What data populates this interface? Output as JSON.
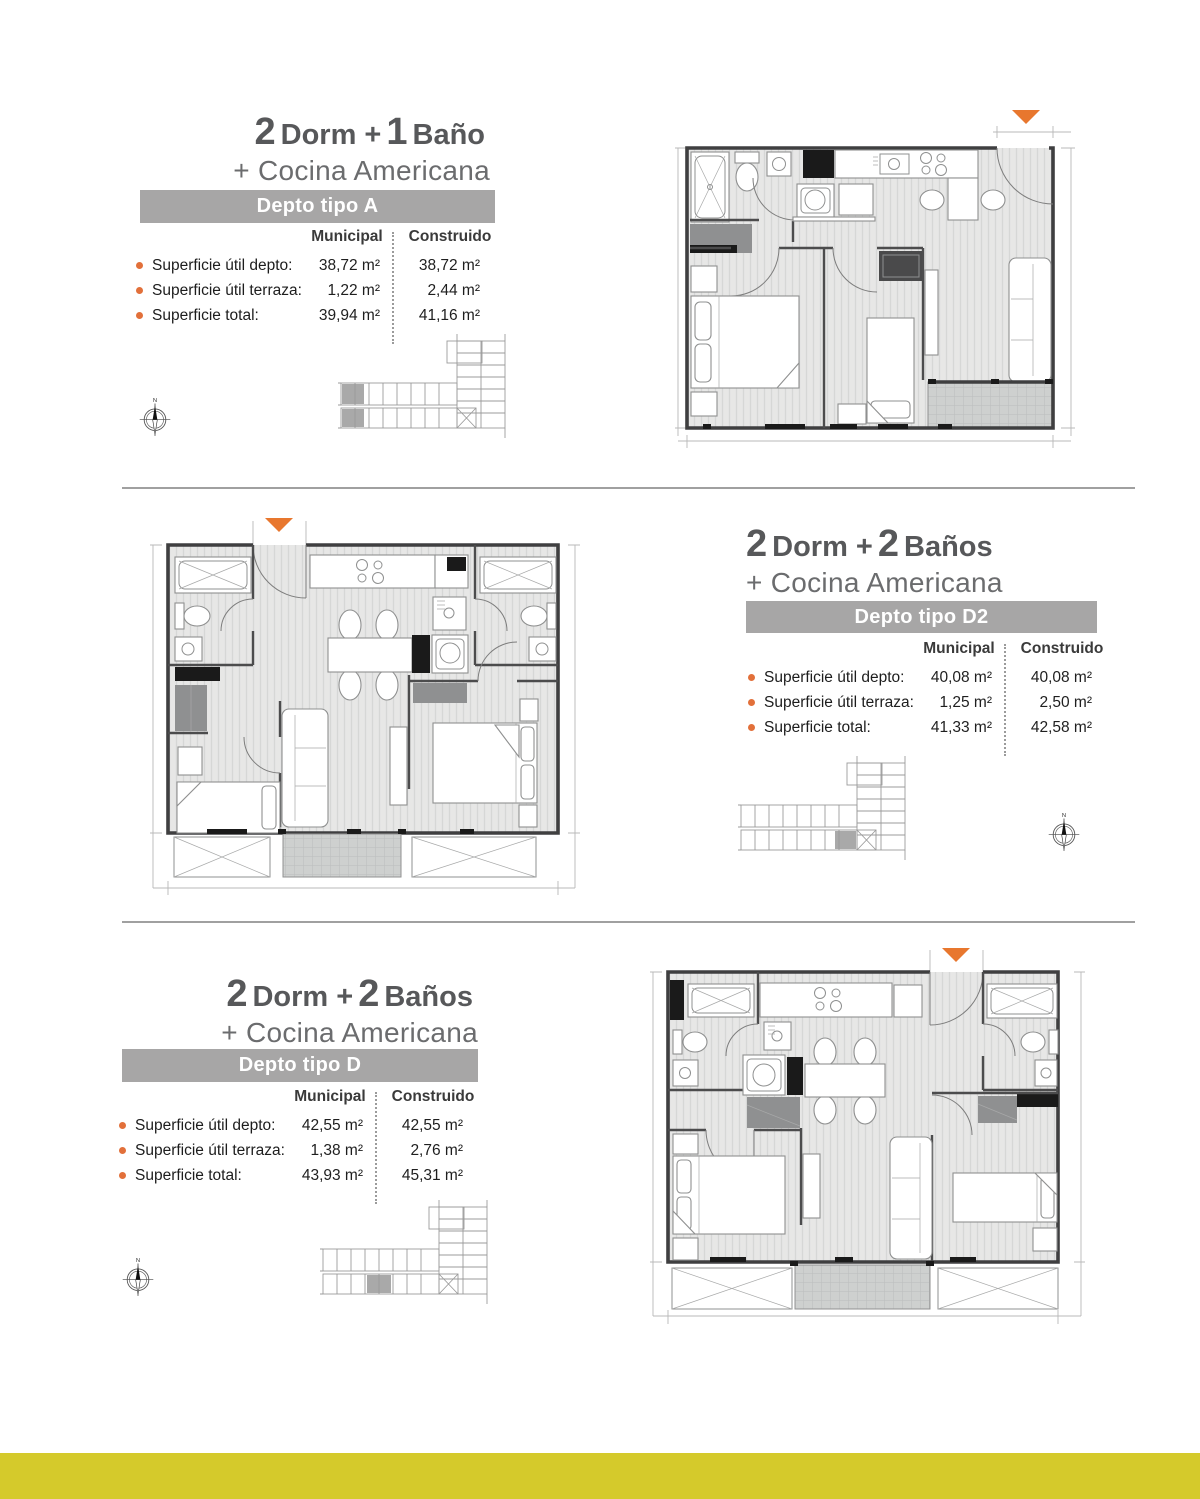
{
  "page": {
    "footer_color": "#d5ca2b",
    "accent_orange": "#e2703a",
    "entry_marker_color": "#e8772e",
    "header_bar_color": "#a7a6a6"
  },
  "compass_label": "N",
  "sections": [
    {
      "title": {
        "n1": "2",
        "t1": "Dorm +",
        "n2": "1",
        "t2": "Baño",
        "subtitle": "+ Cocina Americana"
      },
      "type_label": "Depto tipo A",
      "table": {
        "col_municipal": "Municipal",
        "col_construido": "Construido",
        "rows": [
          {
            "label": "Superficie útil depto:",
            "municipal": "38,72 m²",
            "construido": "38,72 m²"
          },
          {
            "label": "Superficie útil terraza:",
            "municipal": "1,22 m²",
            "construido": "2,44 m²"
          },
          {
            "label": "Superficie total:",
            "municipal": "39,94 m²",
            "construido": "41,16 m²"
          }
        ]
      }
    },
    {
      "title": {
        "n1": "2",
        "t1": "Dorm +",
        "n2": "2",
        "t2": "Baños",
        "subtitle": "+ Cocina Americana"
      },
      "type_label": "Depto tipo D2",
      "table": {
        "col_municipal": "Municipal",
        "col_construido": "Construido",
        "rows": [
          {
            "label": "Superficie útil depto:",
            "municipal": "40,08 m²",
            "construido": "40,08 m²"
          },
          {
            "label": "Superficie útil terraza:",
            "municipal": "1,25 m²",
            "construido": "2,50 m²"
          },
          {
            "label": "Superficie total:",
            "municipal": "41,33 m²",
            "construido": "42,58 m²"
          }
        ]
      }
    },
    {
      "title": {
        "n1": "2",
        "t1": "Dorm +",
        "n2": "2",
        "t2": "Baños",
        "subtitle": "+ Cocina Americana"
      },
      "type_label": "Depto tipo D",
      "table": {
        "col_municipal": "Municipal",
        "col_construido": "Construido",
        "rows": [
          {
            "label": "Superficie útil depto:",
            "municipal": "42,55 m²",
            "construido": "42,55 m²"
          },
          {
            "label": "Superficie útil terraza:",
            "municipal": "1,38 m²",
            "construido": "2,76 m²"
          },
          {
            "label": "Superficie total:",
            "municipal": "43,93 m²",
            "construido": "45,31 m²"
          }
        ]
      }
    }
  ]
}
